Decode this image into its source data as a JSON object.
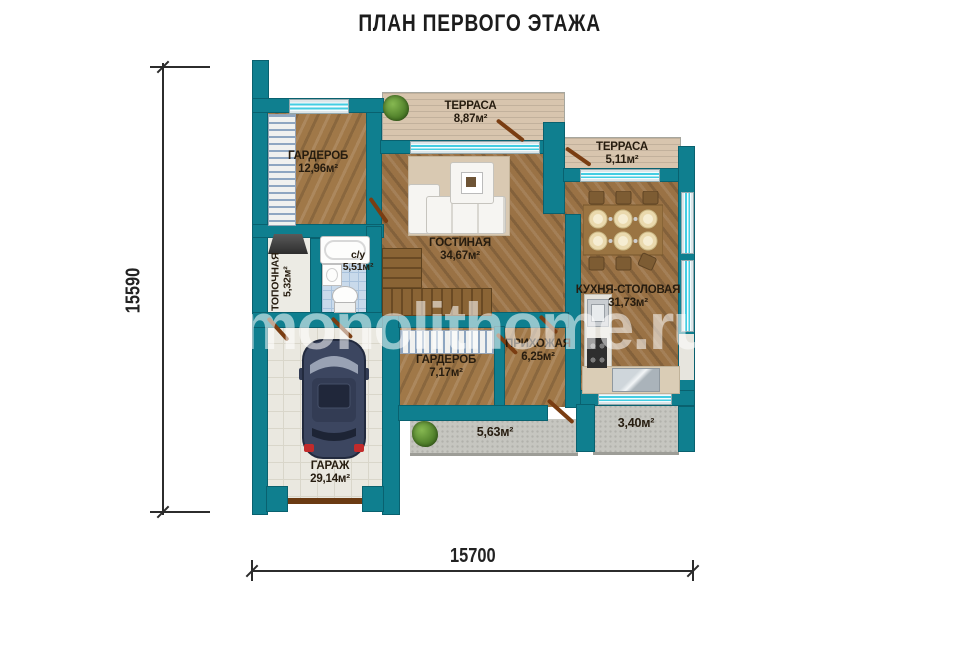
{
  "title": "ПЛАН ПЕРВОГО ЭТАЖА",
  "watermark": "monolithome.ru",
  "dimensions": {
    "left": "15590",
    "bottom": "15700"
  },
  "rooms": {
    "wardrobe_top": {
      "name": "ГАРДЕРОБ",
      "area": "12,96м²"
    },
    "terrace_top": {
      "name": "ТЕРРАСА",
      "area": "8,87м²"
    },
    "terrace_right": {
      "name": "ТЕРРАСА",
      "area": "5,11м²"
    },
    "living": {
      "name": "ГОСТИНАЯ",
      "area": "34,67м²"
    },
    "kitchen": {
      "name": "КУХНЯ-СТОЛОВАЯ",
      "area": "31,73м²"
    },
    "boiler": {
      "name": "ТОПОЧНАЯ",
      "area": "5,32м²"
    },
    "bathroom": {
      "name": "с/у",
      "area": "5,51м²"
    },
    "wardrobe_mid": {
      "name": "ГАРДЕРОБ",
      "area": "7,17м²"
    },
    "hallway": {
      "name": "ПРИХОЖАЯ",
      "area": "6,25м²"
    },
    "porch_front": {
      "area": "5,63м²"
    },
    "porch_back": {
      "area": "3,40м²"
    },
    "garage": {
      "name": "ГАРАЖ",
      "area": "29,14м²"
    }
  },
  "colors": {
    "wall": "#0f7f8f",
    "glass": "#43cde2",
    "wood": "#a07848"
  }
}
